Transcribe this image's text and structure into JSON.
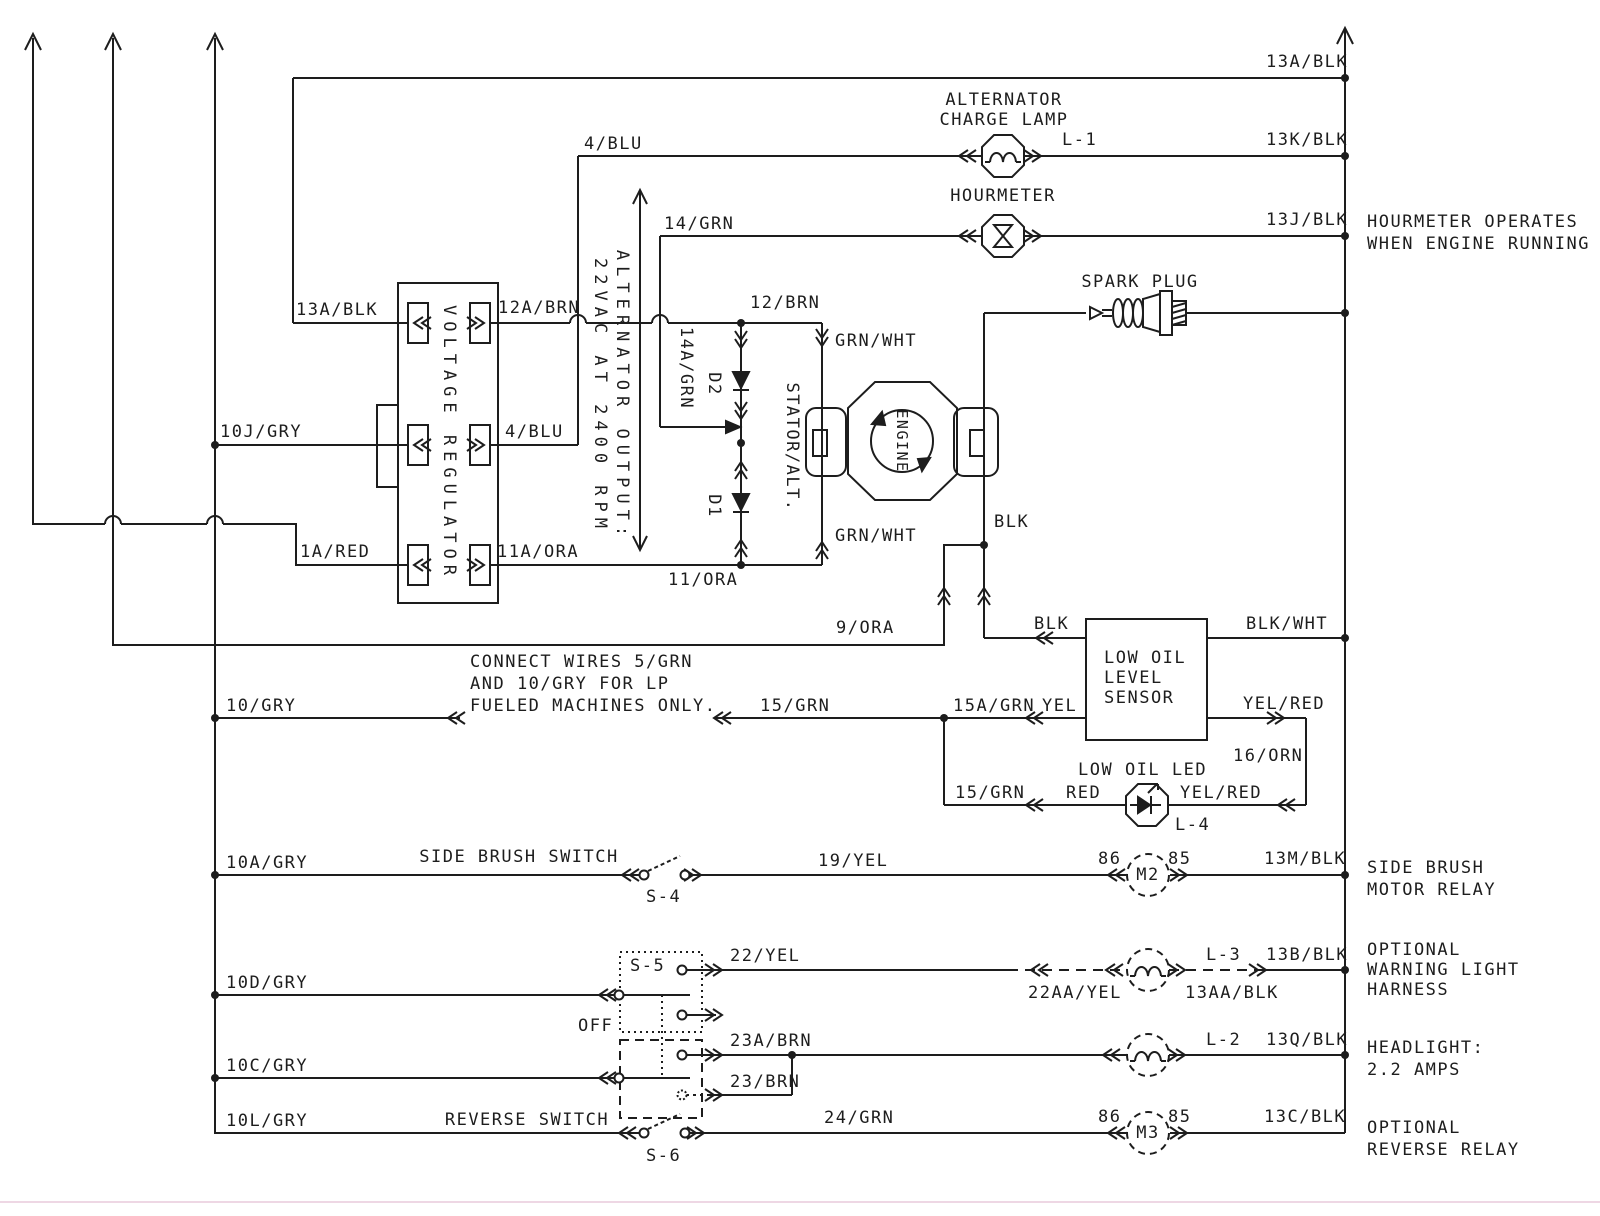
{
  "colors": {
    "background": "#ffffff",
    "line": "#1d1d1d",
    "scan_artifact": "#eed7e4"
  },
  "icons": {
    "lamp": "octagon-with-filament",
    "hourmeter": "octagon-with-hourglass",
    "led": "octagon-with-diode",
    "relay": "dashed-circle",
    "optional_lamp": "dashed-circle-with-filament",
    "junction": "filled-dot",
    "connector": "double-chevron",
    "switch": "open-contact-pair"
  },
  "top": {
    "wire_13a": "13A/BLK"
  },
  "charge_lamp": {
    "title_1": "ALTERNATOR",
    "title_2": "CHARGE LAMP",
    "wire_in": "4/BLU",
    "id": "L-1",
    "wire_out": "13K/BLK"
  },
  "hourmeter": {
    "title": "HOURMETER",
    "wire_in": "14/GRN",
    "wire_out": "13J/BLK",
    "note_1": "HOURMETER OPERATES",
    "note_2": "WHEN ENGINE RUNNING"
  },
  "spark_plug": {
    "title": "SPARK PLUG"
  },
  "regulator": {
    "title": "VOLTAGE REGULATOR",
    "in_top": "13A/BLK",
    "out_top": "12A/BRN",
    "in_mid": "10J/GRY",
    "out_mid": "4/BLU",
    "in_bot": "1A/RED",
    "out_bot": "11A/ORA"
  },
  "alt_output": {
    "line_1": "ALTERNATOR OUTPUT:",
    "line_2": "22VAC AT 2400 RPM"
  },
  "stator": {
    "title": "STATOR/ALT.",
    "wire_top": "12/BRN",
    "wire_14a": "14A/GRN",
    "diode_top": "D2",
    "diode_bot": "D1",
    "grn_wht_top": "GRN/WHT",
    "grn_wht_bot": "GRN/WHT",
    "wire_bot": "11/ORA"
  },
  "engine": {
    "title": "ENGINE",
    "wire_blk": "BLK",
    "wire_9ora": "9/ORA"
  },
  "oil_sensor": {
    "title_1": "LOW OIL",
    "title_2": "LEVEL",
    "title_3": "SENSOR",
    "wire_blk": "BLK",
    "wire_blk_wht": "BLK/WHT",
    "wire_15a": "15A/GRN",
    "wire_yel": "YEL",
    "wire_yel_red": "YEL/RED",
    "wire_16": "16/ORN"
  },
  "oil_led": {
    "title": "LOW OIL LED",
    "id": "L-4",
    "wire_15": "15/GRN",
    "wire_red": "RED",
    "wire_yel_red": "YEL/RED"
  },
  "lp_note": {
    "wire_10": "10/GRY",
    "line_1": "CONNECT WIRES 5/GRN",
    "line_2": "AND 10/GRY FOR LP",
    "line_3": "FUELED MACHINES ONLY.",
    "wire_15": "15/GRN"
  },
  "side_brush": {
    "wire_in": "10A/GRY",
    "switch": "SIDE BRUSH SWITCH",
    "switch_id": "S-4",
    "wire_19": "19/YEL",
    "pin_86": "86",
    "pin_85": "85",
    "relay": "M2",
    "wire_out": "13M/BLK",
    "desc_1": "SIDE BRUSH",
    "desc_2": "MOTOR RELAY"
  },
  "warning_light": {
    "wire_in": "10D/GRY",
    "switch_id": "S-5",
    "off": "OFF",
    "wire_22": "22/YEL",
    "wire_22aa": "22AA/YEL",
    "lamp_id": "L-3",
    "wire_13aa": "13AA/BLK",
    "wire_out": "13B/BLK",
    "desc_1": "OPTIONAL",
    "desc_2": "WARNING LIGHT",
    "desc_3": "HARNESS"
  },
  "headlight": {
    "wire_in": "10C/GRY",
    "wire_23a": "23A/BRN",
    "wire_23": "23/BRN",
    "lamp_id": "L-2",
    "wire_out": "13Q/BLK",
    "desc_1": "HEADLIGHT:",
    "desc_2": "2.2 AMPS"
  },
  "reverse": {
    "wire_in": "10L/GRY",
    "switch": "REVERSE SWITCH",
    "switch_id": "S-6",
    "wire_24": "24/GRN",
    "pin_86": "86",
    "pin_85": "85",
    "relay": "M3",
    "wire_out": "13C/BLK",
    "desc_1": "OPTIONAL",
    "desc_2": "REVERSE RELAY"
  }
}
